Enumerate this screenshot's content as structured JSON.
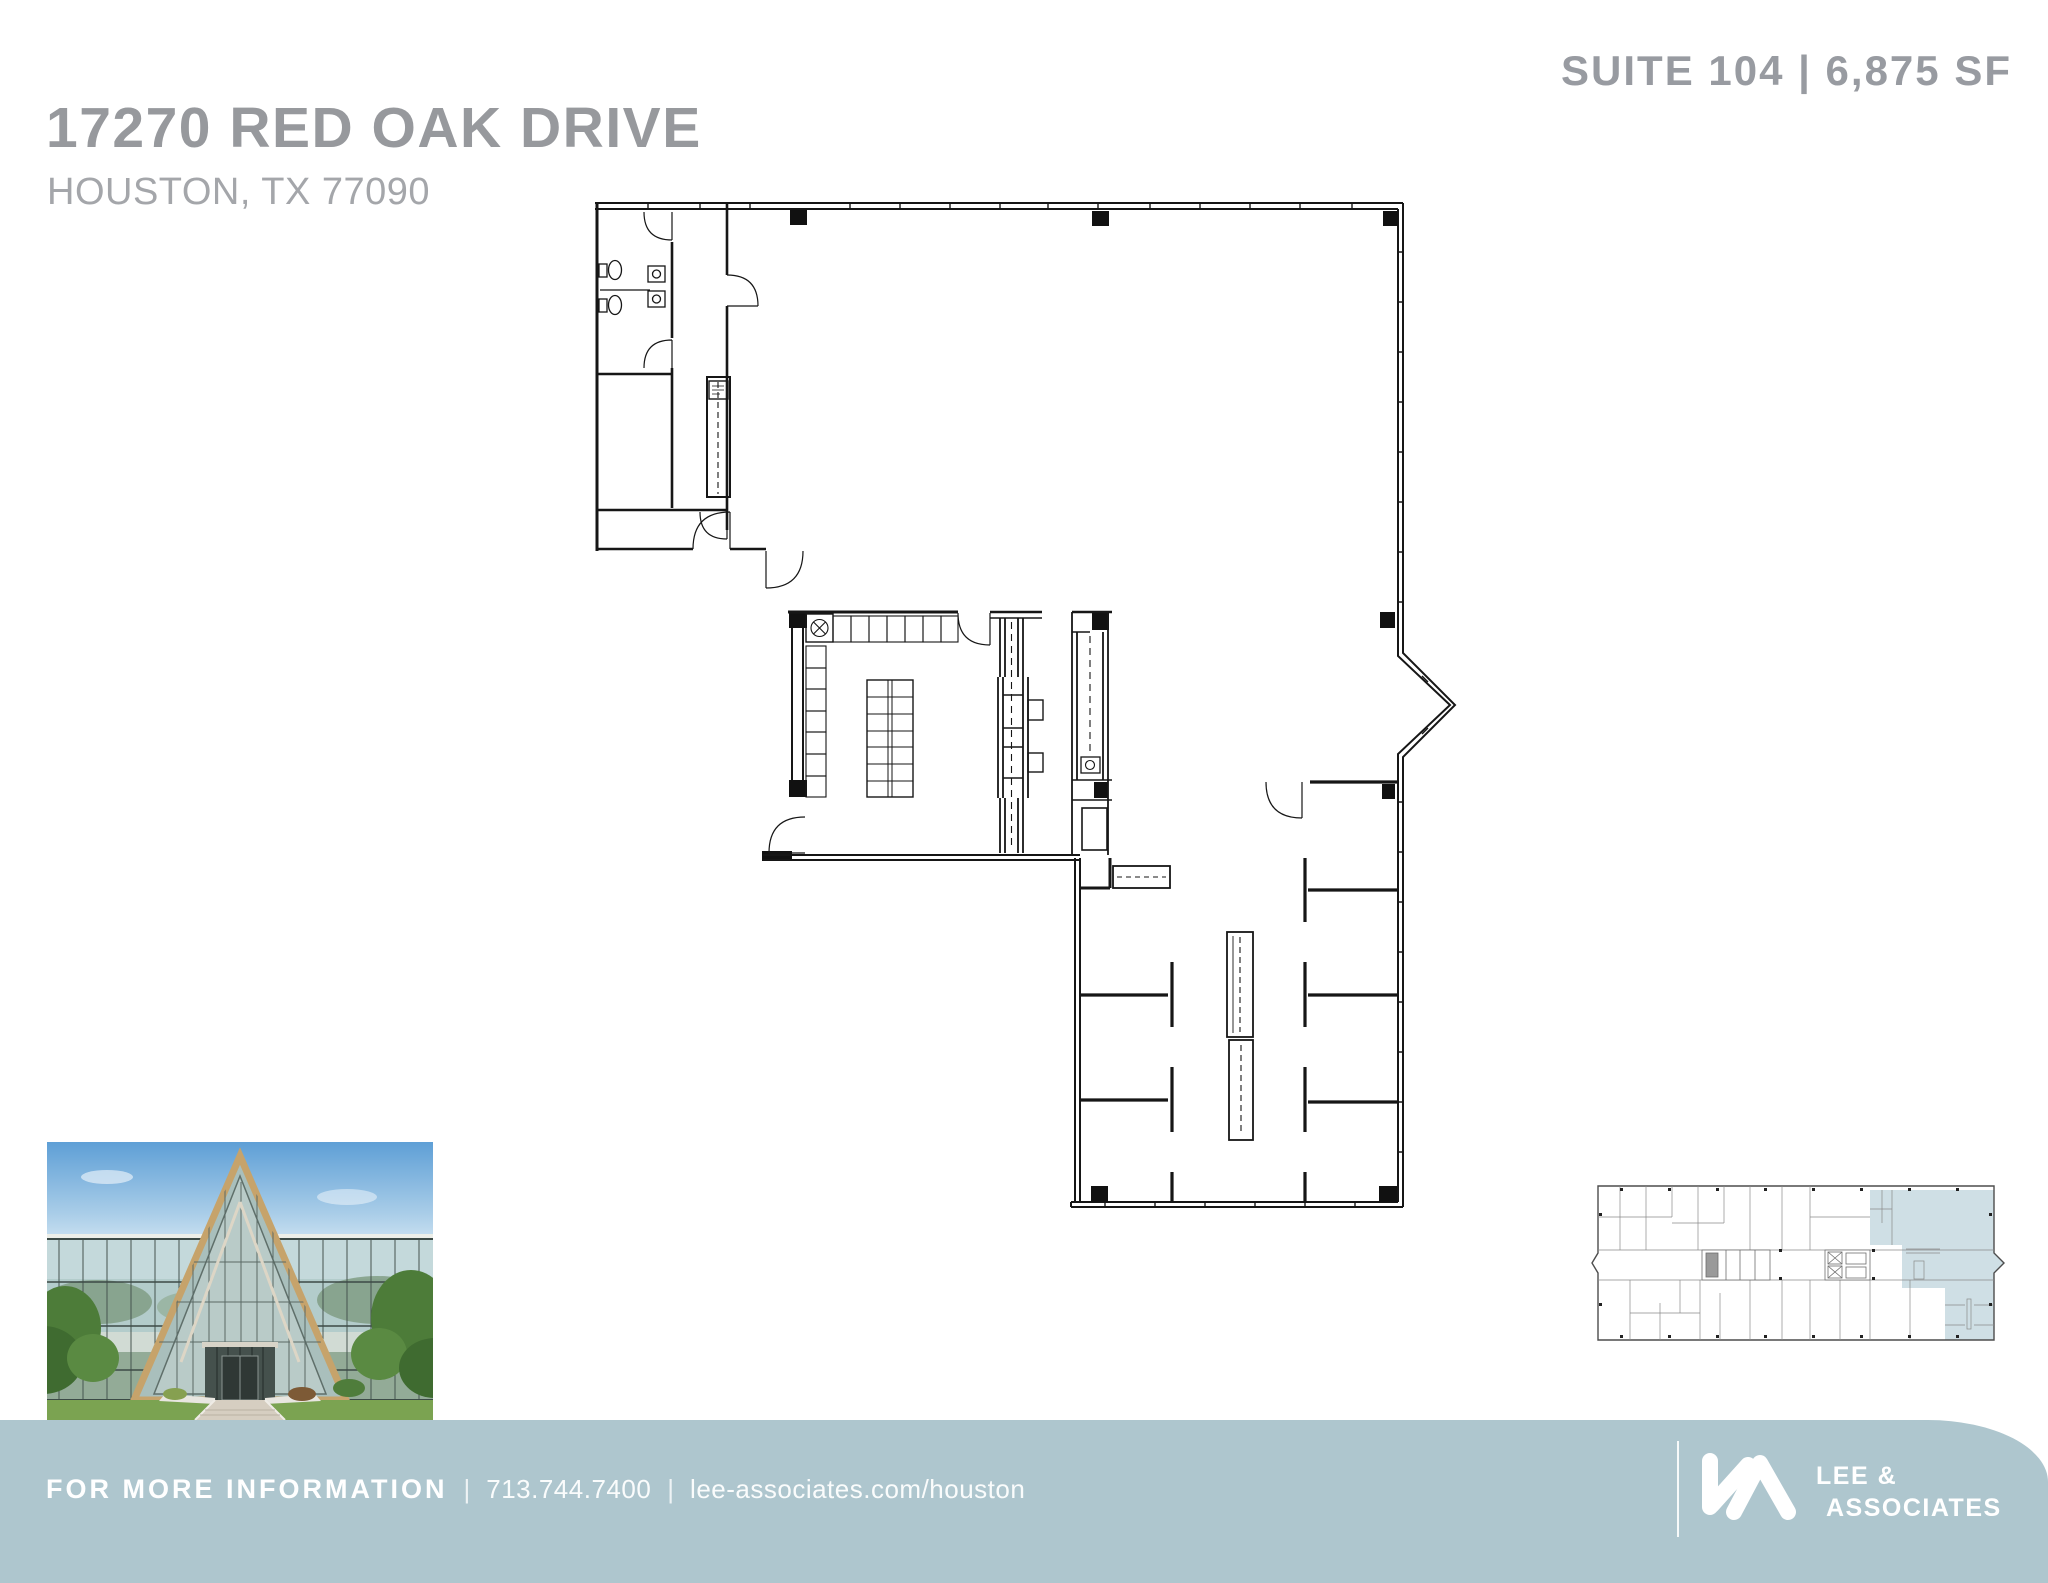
{
  "header": {
    "title": "17270 RED OAK DRIVE",
    "address": "HOUSTON, TX 77090",
    "suite_label": "SUITE 104 | 6,875 SF"
  },
  "graphics": {
    "floor_plan": "suite-104-floor-plan-drawing",
    "key_plan": "building-key-plan-suite-highlighted",
    "photo": "building-entrance-photo"
  },
  "colors": {
    "title_gray": "#97999d",
    "subtitle_gray": "#a4a6aa",
    "suite_gray": "#989ba1",
    "footer_teal": "#aec6ce",
    "footer_text": "#ffffff",
    "plan_line": "#161616",
    "keyplan_highlight": "#cfdfe5"
  },
  "footer": {
    "info_label": "FOR MORE INFORMATION",
    "separator": "|",
    "phone": "713.744.7400",
    "website": "lee-associates.com/houston",
    "brand": {
      "line1": "LEE &",
      "line2": "ASSOCIATES"
    }
  }
}
